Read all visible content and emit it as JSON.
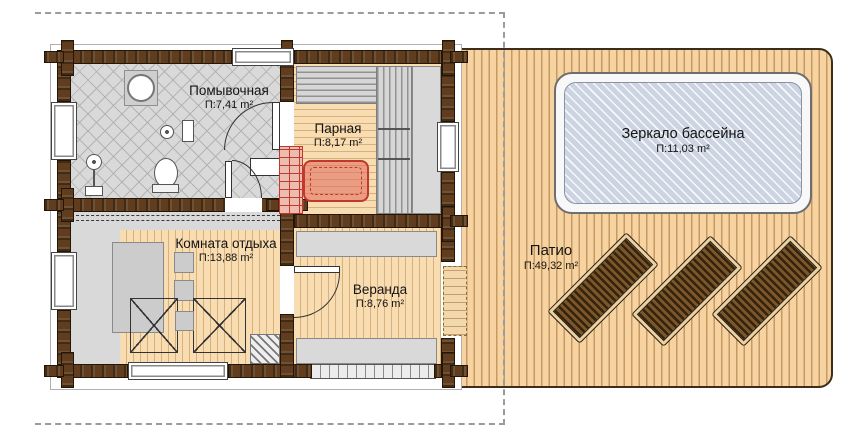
{
  "plan": {
    "rooms": [
      {
        "id": "washing",
        "name": "Помывочная",
        "area": "П:7,41 m²"
      },
      {
        "id": "steam",
        "name": "Парная",
        "area": "П:8,17 m²"
      },
      {
        "id": "rest",
        "name": "Комната отдыха",
        "area": "П:13,88 m²"
      },
      {
        "id": "veranda",
        "name": "Веранда",
        "area": "П:8,76 m²"
      },
      {
        "id": "pool",
        "name": "Зеркало бассейна",
        "area": "П:11,03 m²"
      },
      {
        "id": "patio",
        "name": "Патио",
        "area": "П:49,32 m²"
      }
    ],
    "loungers_count": 3,
    "colors": {
      "patio_deck": "#f6d3a0",
      "floor_wood": "#f8dcb2",
      "wall_log": "#5f3d1e",
      "tile": "#d9d9d9",
      "bench": "#d6d6d6",
      "pool_water": "#ccd4e2",
      "stove_accent": "#c0392b",
      "lounger_wood": "#6f4d26",
      "boundary_dash": "#9b9b9b"
    }
  }
}
